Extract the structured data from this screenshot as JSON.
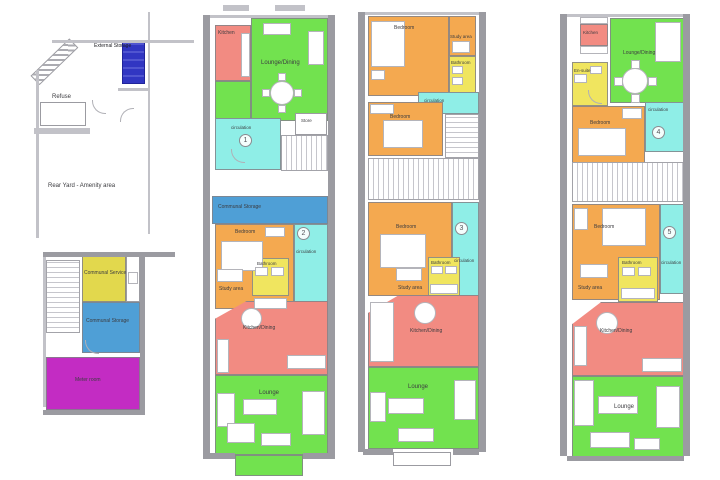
{
  "document": {
    "type": "architectural floor plan sheet",
    "plan_count": 4
  },
  "colors": {
    "wall": "#9b9ba1",
    "kitchen_red": "#f28b82",
    "lounge_green": "#72e24f",
    "circulation_cyan": "#8feee7",
    "bedroom_orange": "#f4a950",
    "bathroom_yellow": "#f0e55f",
    "communal_storage_blue": "#4f9fd6",
    "communal_service_yellow": "#e2d84d",
    "meter_room_magenta": "#c32cc3",
    "external_storage_blue": "#3136c2"
  },
  "site_plan": {
    "external_storage": "External Storage",
    "refuse": "Refuse",
    "rear_yard": "Rear Yard - Amenity area"
  },
  "ground_floor": {
    "communal_service": "Communal Service",
    "communal_storage": "Communal Storage",
    "meter_room": "Meter room"
  },
  "plan2": {
    "kitchen": "Kitchen",
    "lounge_dining": "Lounge/Dining",
    "circulation_1": "circulation",
    "store": "Store",
    "unit_1": "1",
    "communal_storage": "Communal Storage",
    "bedroom": "Bedroom",
    "unit_2": "2",
    "circulation_2": "circulation",
    "bathroom": "Bathroom",
    "study_area": "Study area",
    "kitchen_dining": "Kitchen/Dining",
    "lounge": "Lounge"
  },
  "plan3": {
    "bedroom_1": "Bedroom",
    "study_area_1": "Study area",
    "bathroom_1": "Bathroom",
    "circulation_1": "circulation",
    "bedroom_2": "Bedroom",
    "bedroom_3": "Bedroom",
    "unit_3": "3",
    "circulation_2": "circulation",
    "bathroom_2": "Bathroom",
    "study_area_2": "Study area",
    "kitchen_dining": "Kitchen/Dining",
    "lounge": "Lounge"
  },
  "plan4": {
    "kitchen": "Kitchen",
    "lounge_dining": "Lounge/Dining",
    "en_suite": "En-suite",
    "bedroom_4": "Bedroom",
    "circulation_4": "circulation",
    "unit_4": "4",
    "bedroom_5": "Bedroom",
    "unit_5": "5",
    "circulation_5": "circulation",
    "bathroom": "Bathroom",
    "study_area": "Study area",
    "kitchen_dining": "Kitchen/Dining",
    "lounge": "Lounge"
  }
}
